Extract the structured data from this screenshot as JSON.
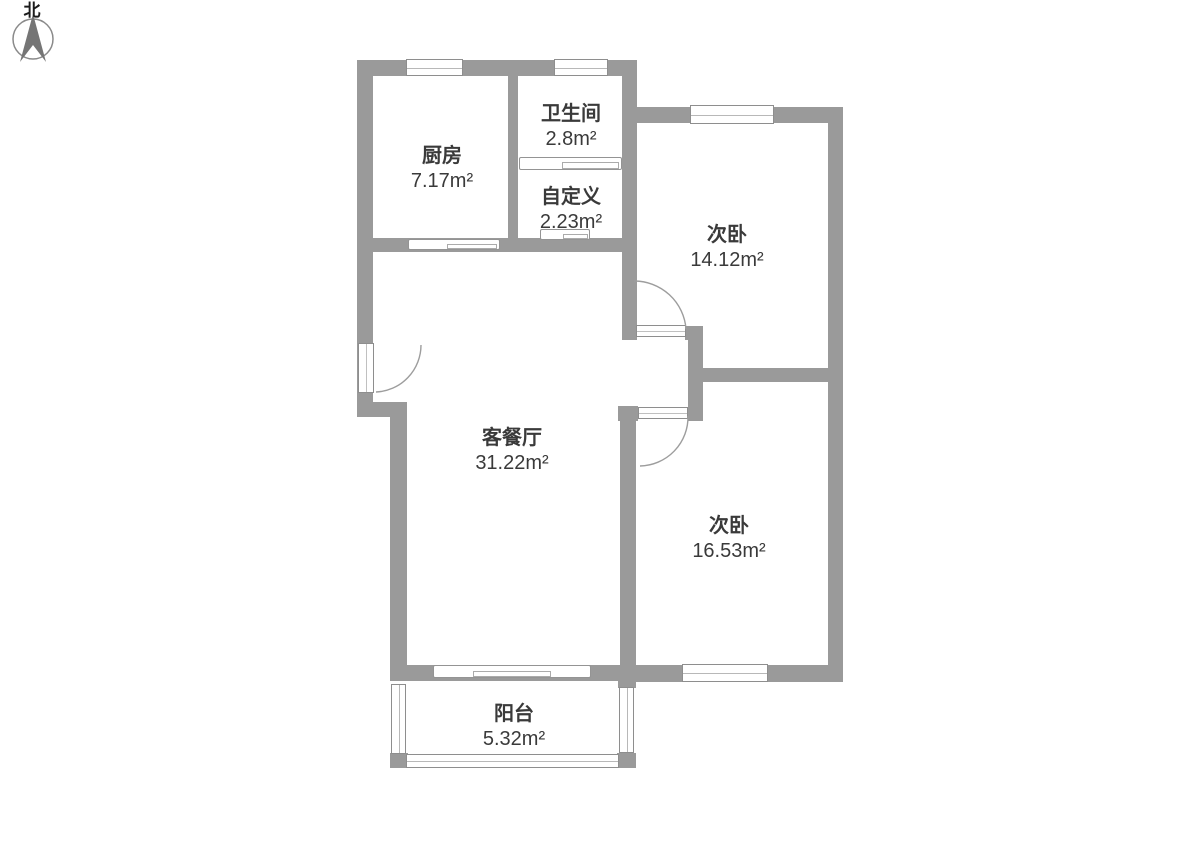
{
  "compass": {
    "north_label": "北"
  },
  "rooms": {
    "kitchen": {
      "name": "厨房",
      "area": "7.17m²"
    },
    "bathroom": {
      "name": "卫生间",
      "area": "2.8m²"
    },
    "custom": {
      "name": "自定义",
      "area": "2.23m²"
    },
    "bedroom_top": {
      "name": "次卧",
      "area": "14.12m²"
    },
    "living_dining": {
      "name": "客餐厅",
      "area": "31.22m²"
    },
    "bedroom_bottom": {
      "name": "次卧",
      "area": "16.53m²"
    },
    "balcony": {
      "name": "阳台",
      "area": "5.32m²"
    }
  },
  "colors": {
    "wall": "#9a9a9a",
    "text": "#3a3a3a",
    "door_arc": "#9d9d9d",
    "background": "#ffffff"
  }
}
